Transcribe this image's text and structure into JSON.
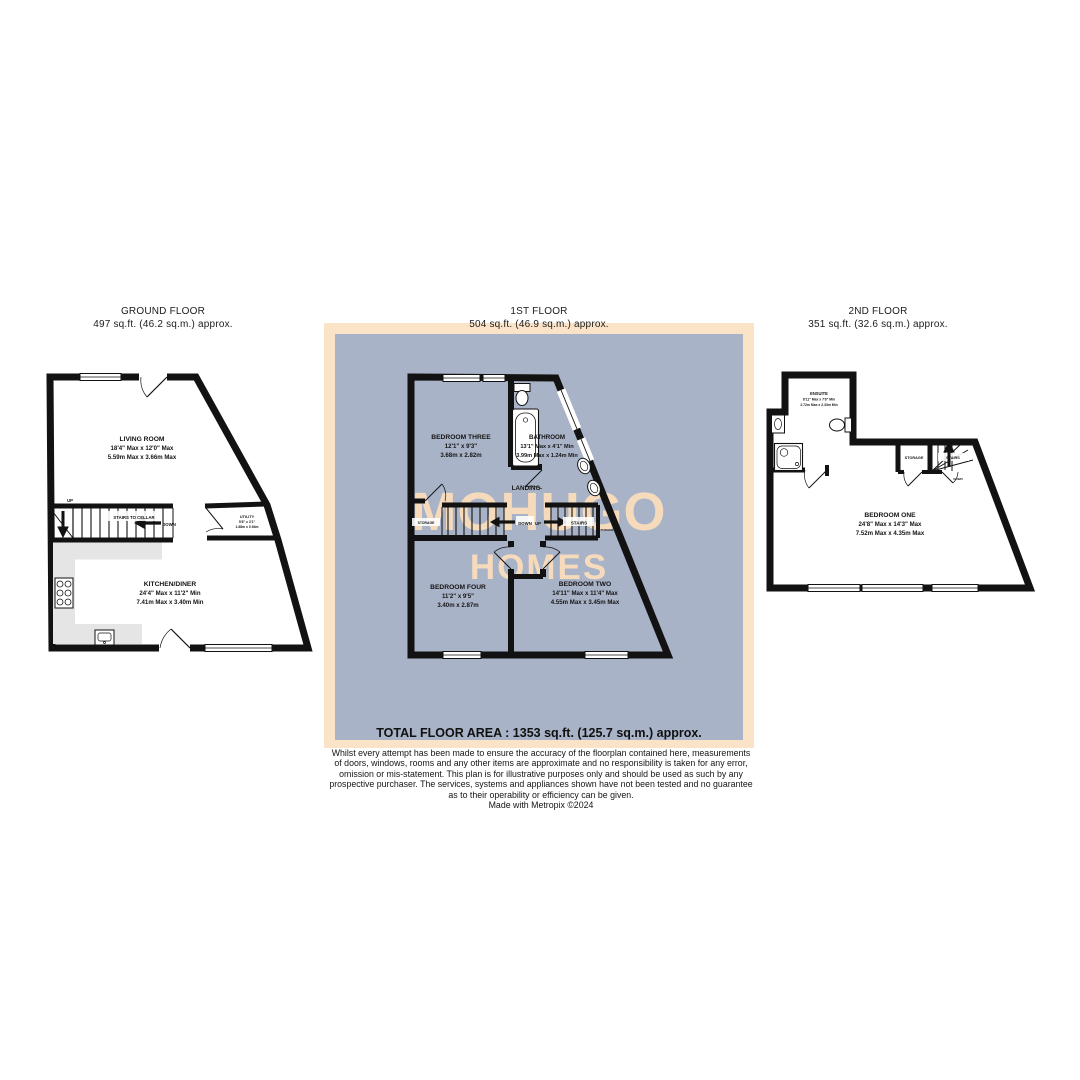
{
  "colors": {
    "panel_peach": "#fbe3c8",
    "panel_blue": "#a9b3c7",
    "wall": "#121212",
    "kitchen_counter": "#e5e5e5",
    "watermark_text": "#f6dabc"
  },
  "watermark": {
    "line1": "MOHUGO",
    "line2": "HOMES"
  },
  "labels": {
    "up": "UP",
    "down": "DOWN",
    "storage": "STORAGE",
    "stairs": "STAIRS",
    "landing": "LANDING",
    "stairs_to_cellar": "STAIRS TO CELLAR"
  },
  "floors": {
    "ground": {
      "title": "GROUND FLOOR",
      "area": "497 sq.ft. (46.2 sq.m.) approx.",
      "rooms": {
        "living": {
          "name": "LIVING ROOM",
          "imperial": "18'4\" Max x 12'0\" Max",
          "metric": "5.59m Max x 3.66m Max"
        },
        "kitchen": {
          "name": "KITCHEN/DINER",
          "imperial": "24'4\" Max x 11'2\" Min",
          "metric": "7.41m Max x 3.40m Min"
        },
        "utility": {
          "name": "UTILITY",
          "imperial": "5'6\" x 3'1\"",
          "metric": "1.68m x 0.94m"
        }
      }
    },
    "first": {
      "title": "1ST FLOOR",
      "area": "504 sq.ft. (46.9 sq.m.) approx.",
      "rooms": {
        "bedroom_three": {
          "name": "BEDROOM THREE",
          "imperial": "12'1\" x 9'3\"",
          "metric": "3.68m x 2.82m"
        },
        "bathroom": {
          "name": "BATHROOM",
          "imperial": "13'1\" Max x 4'1\" Min",
          "metric": "3.99m Max x 1.24m Min"
        },
        "bedroom_four": {
          "name": "BEDROOM FOUR",
          "imperial": "11'2\" x 9'5\"",
          "metric": "3.40m x 2.87m"
        },
        "bedroom_two": {
          "name": "BEDROOM TWO",
          "imperial": "14'11\" Max x 11'4\" Max",
          "metric": "4.55m Max x 3.45m Max"
        }
      }
    },
    "second": {
      "title": "2ND FLOOR",
      "area": "351 sq.ft. (32.6 sq.m.) approx.",
      "rooms": {
        "ensuite": {
          "name": "ENSUITE",
          "imperial": "8'11\" Max x 7'8\" Min",
          "metric": "2.72m Max x 2.33m Min"
        },
        "bedroom_one": {
          "name": "BEDROOM ONE",
          "imperial": "24'8\" Max x 14'3\" Max",
          "metric": "7.52m Max x 4.35m Max"
        }
      }
    }
  },
  "summary": {
    "total_area": "TOTAL FLOOR AREA : 1353 sq.ft. (125.7 sq.m.) approx.",
    "disclaimer": [
      "Whilst every attempt has been made to ensure the accuracy of the floorplan contained here, measurements",
      "of doors, windows, rooms and any other items are approximate and no responsibility is taken for any error,",
      "omission or mis-statement. This plan is for illustrative purposes only and should be used as such by any",
      "prospective purchaser. The services, systems and appliances shown have not been tested and no guarantee",
      "as to their operability or efficiency can be given."
    ],
    "credit": "Made with Metropix ©2024"
  }
}
